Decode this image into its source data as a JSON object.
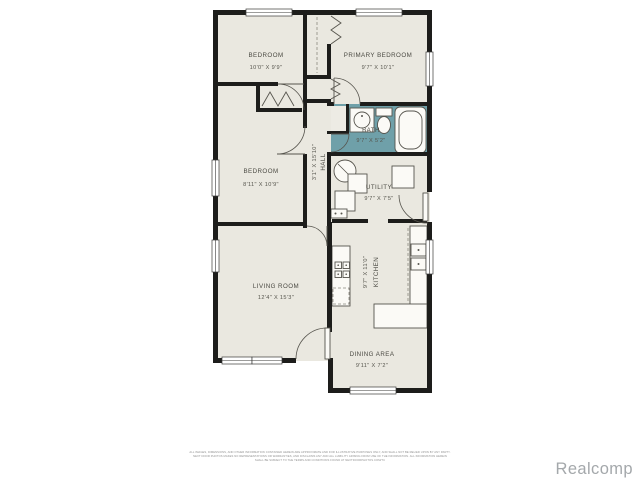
{
  "floorplan": {
    "rooms": {
      "bedroom1": {
        "name": "BEDROOM",
        "dims": "10'0\" X 9'9\""
      },
      "primary": {
        "name": "PRIMARY BEDROOM",
        "dims": "9'7\" X 10'1\""
      },
      "bath": {
        "name": "BATH",
        "dims": "9'7\" X 5'2\""
      },
      "bedroom2": {
        "name": "BEDROOM",
        "dims": "8'11\" X 10'9\""
      },
      "hall": {
        "name": "HALL",
        "dims": "3'1\" X 15'10\""
      },
      "utility": {
        "name": "UTILITY",
        "dims": "9'7\" X 7'5\""
      },
      "living": {
        "name": "LIVING ROOM",
        "dims": "12'4\" X 15'3\""
      },
      "kitchen": {
        "name": "KITCHEN",
        "dims": "9'7\" X 11'0\""
      },
      "dining": {
        "name": "DINING AREA",
        "dims": "9'11\" X 7'2\""
      }
    },
    "colors": {
      "floor": "#eae8e0",
      "wall": "#1d1d1b",
      "bath_floor": "#6fa0a9",
      "brand_gray": "#a4a8ab"
    }
  },
  "footer": {
    "disclaimer_line1": "ALL IMAGES, DIMENSIONS, AND OTHER INFORMATION CONTAINED HEREIN ARE APPROXIMATE AND FOR ILLUSTRATIVE PURPOSES ONLY, AND SHALL NOT BE RELIED UPON BY ANY PARTY.",
    "disclaimer_line2": "NEXT DOOR PHOTOS MAKES NO REPRESENTATIONS OR WARRANTIES, AND DISCLAIMS ANY AND ALL LIABILITY ARISING FROM USE OF THE INFORMATION. ALL INFORMATION HEREIN",
    "disclaimer_line3": "SHALL BE SUBJECT TO THE TERMS AND CONDITIONS FOUND AT NEXTDOORPHOTOS.COM/TC",
    "brand": "Realcomp"
  }
}
